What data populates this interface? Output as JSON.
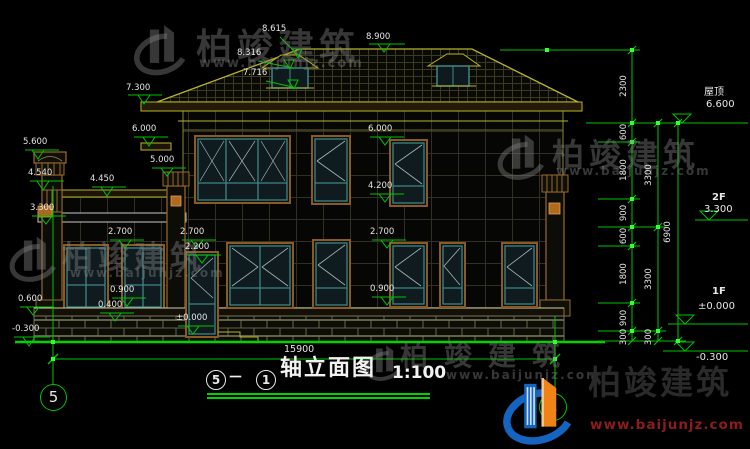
{
  "drawing": {
    "title": {
      "axis_start": "5",
      "separator": "－",
      "axis_end": "1",
      "name": "轴立面图",
      "scale": "1:100"
    },
    "axis_bubbles": {
      "left": "5",
      "right": "1"
    },
    "floor_levels": {
      "roof_label": "屋顶",
      "roof_value": "6.600",
      "f2_label": "2F",
      "f2_value": "3.300",
      "f1_label": "1F",
      "f1_value": "±0.000",
      "ground_value": "-0.300"
    },
    "elevation_markers": {
      "ridge": "8.900",
      "roof_upper": "8.615",
      "roof_mid": "8.316",
      "dormer_base": "7.716",
      "eave": "7.300",
      "canopy_left": "6.000",
      "pillar_left_top": "5.600",
      "porch_pillar_top": "5.000",
      "pillar_cap": "4.540",
      "porch_parapet": "4.450",
      "porch_band": "3.300",
      "porch_window_top": "2.700",
      "door_window_top": "2.700",
      "door_top": "2.200",
      "porch_sill": "0.900",
      "porch_base": "0.400",
      "plinth": "0.600",
      "ground_left": "-0.300",
      "f2_window_top": "6.000",
      "f2_sill": "4.200",
      "f1_window_top": "2.700",
      "f1_sill": "0.900",
      "door_floor": "±0.000"
    },
    "dimensions": {
      "total_width": "15900",
      "right_col1": [
        "2300",
        "600",
        "1800",
        "900",
        "600",
        "1800",
        "900",
        "300"
      ],
      "right_col2": [
        "3300",
        "3300",
        "300"
      ],
      "right_col3": "6900"
    }
  },
  "watermark": {
    "brand": "柏竣建筑",
    "url": "www.baijunjz.com"
  },
  "colors": {
    "dim_green": "#00c300",
    "outline_yellow": "#b8b428",
    "trim_brown": "#8a5a20",
    "frame_teal": "#3e8787",
    "logo_blue": "#1565c0",
    "logo_orange": "#ef8318",
    "url_red": "#8b1d1d"
  }
}
